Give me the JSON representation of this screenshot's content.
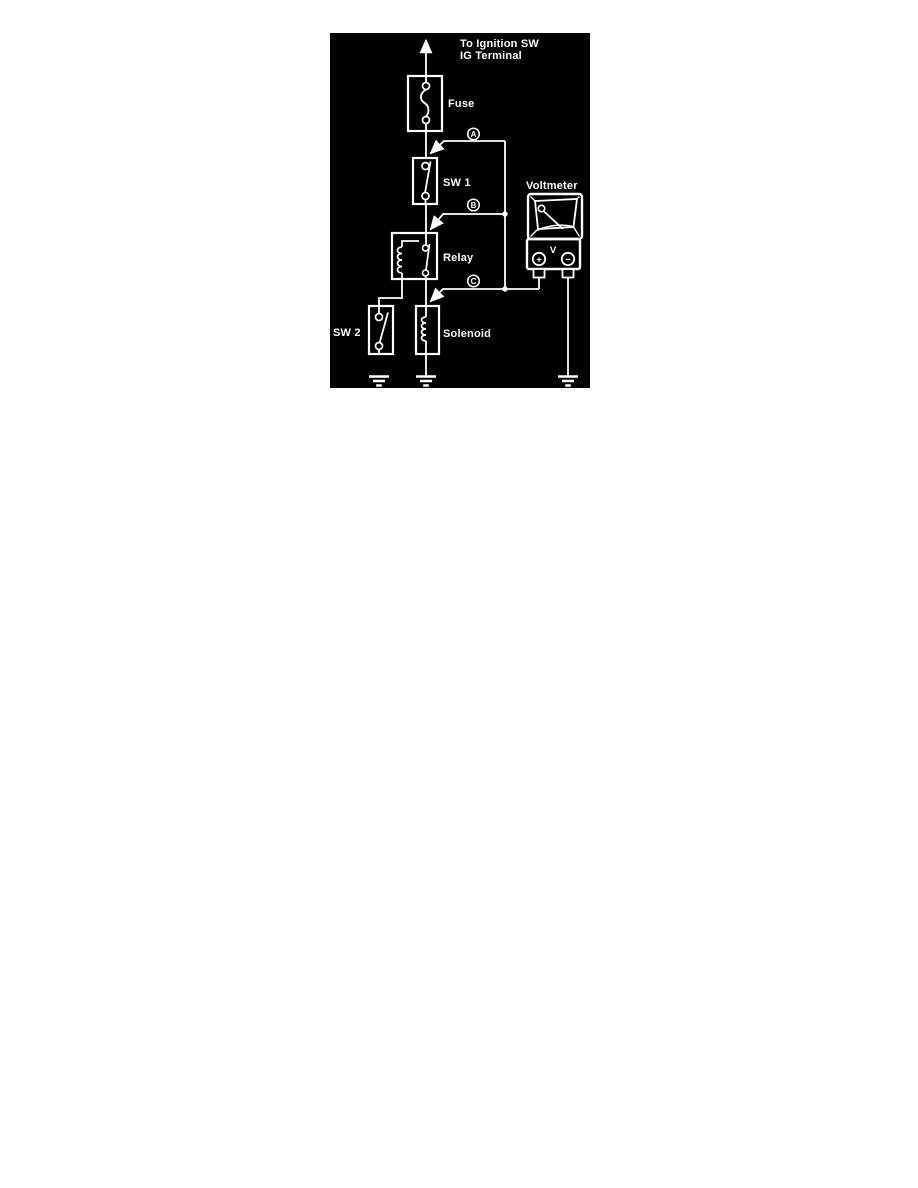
{
  "colors": {
    "page_bg": "#ffffff",
    "panel_bg": "#000000",
    "line": "#ffffff"
  },
  "diagram": {
    "header_line1": "To Ignition SW",
    "header_line2": "IG Terminal",
    "labels": {
      "fuse": "Fuse",
      "sw1": "SW 1",
      "voltmeter": "Voltmeter",
      "relay": "Relay",
      "sw2": "SW 2",
      "solenoid": "Solenoid"
    },
    "test_points": {
      "a": "A",
      "b": "B",
      "c": "C"
    },
    "voltmeter": {
      "unit": "V",
      "plus_symbol": "+",
      "minus_symbol": "−"
    }
  }
}
